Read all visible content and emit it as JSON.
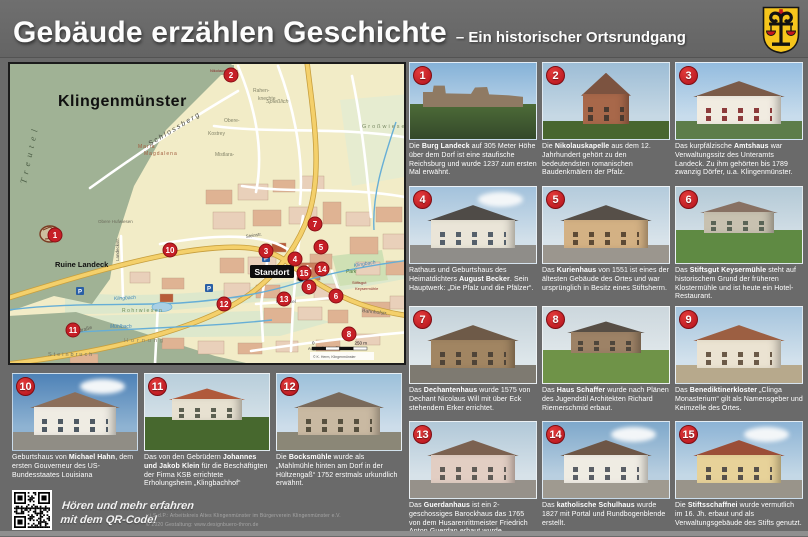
{
  "header": {
    "title": "Gebäude erzählen Geschichte",
    "subtitle": "– Ein historischer Ortsrundgang"
  },
  "map": {
    "title": "Klingenmünster",
    "standort_label": "Standort",
    "scale_zero": "0",
    "scale_label": "250 m",
    "credit": "© K. Herm, Klingenmünster",
    "labels": [
      {
        "t": "Klingenmünster",
        "x": 48,
        "y": 42,
        "s": 16,
        "c": "#101010",
        "b": true,
        "ls": 0.5
      },
      {
        "t": "Treutel",
        "x": 16,
        "y": 120,
        "s": 9,
        "c": "#4e6048",
        "r": -78,
        "i": true,
        "ls": 5,
        "serif": true
      },
      {
        "t": "S c h l o s s b e r g",
        "x": 140,
        "y": 82,
        "s": 7,
        "c": "#4a4a42",
        "r": -31,
        "i": true
      },
      {
        "t": "Ruine Landeck",
        "x": 45,
        "y": 203,
        "s": 7.5,
        "c": "#101010",
        "b": true
      },
      {
        "t": "Maria",
        "x": 128,
        "y": 84,
        "s": 5,
        "c": "#a05a3c",
        "ls": 1
      },
      {
        "t": "Magdalena",
        "x": 134,
        "y": 91,
        "s": 5,
        "c": "#a05a3c",
        "ls": 1
      },
      {
        "t": "Spießlich",
        "x": 256,
        "y": 39,
        "s": 5.5,
        "c": "#85856a",
        "i": true
      },
      {
        "t": "Obere-",
        "x": 214,
        "y": 58,
        "s": 5,
        "c": "#85856a"
      },
      {
        "t": "Kostrey",
        "x": 198,
        "y": 71,
        "s": 5,
        "c": "#85856a"
      },
      {
        "t": "Rahen-",
        "x": 243,
        "y": 28,
        "s": 5,
        "c": "#85856a"
      },
      {
        "t": "knechte",
        "x": 248,
        "y": 36,
        "s": 5,
        "c": "#85856a"
      },
      {
        "t": "Mistlara-",
        "x": 205,
        "y": 92,
        "s": 5,
        "c": "#85856a"
      },
      {
        "t": "Großwiesen",
        "x": 352,
        "y": 64,
        "s": 5.5,
        "c": "#7a8a64",
        "ls": 2
      },
      {
        "t": "Rohrwiesen",
        "x": 112,
        "y": 248,
        "s": 5,
        "c": "#6f8c55",
        "ls": 1.5
      },
      {
        "t": "Hornung",
        "x": 114,
        "y": 278,
        "s": 5.5,
        "c": "#85856a",
        "ls": 3
      },
      {
        "t": "Steinbruch",
        "x": 38,
        "y": 292,
        "s": 5.5,
        "c": "#73735f",
        "ls": 2
      },
      {
        "t": "Klingbach",
        "x": 104,
        "y": 236,
        "s": 5,
        "c": "#3e86b8",
        "i": true,
        "r": -3
      },
      {
        "t": "Klingbach",
        "x": 344,
        "y": 203,
        "s": 5,
        "c": "#3e86b8",
        "i": true,
        "r": -9
      },
      {
        "t": "Mühlbach",
        "x": 100,
        "y": 264,
        "s": 5,
        "c": "#3e86b8",
        "i": true
      },
      {
        "t": "Weinstraße",
        "x": 58,
        "y": 272,
        "s": 5,
        "c": "#5a5a52",
        "r": -17
      },
      {
        "t": "Steinstr.",
        "x": 236,
        "y": 174,
        "s": 4.5,
        "c": "#5a5a52",
        "r": -9
      },
      {
        "t": "Im Winkel",
        "x": 266,
        "y": 239,
        "s": 4.5,
        "c": "#5a5a52"
      },
      {
        "t": "Bahnhofstr.",
        "x": 352,
        "y": 248,
        "s": 5,
        "c": "#5a5a52",
        "r": 7
      },
      {
        "t": "Landeckstr.",
        "x": 109,
        "y": 197,
        "s": 4.5,
        "c": "#5a5a52",
        "r": -90
      },
      {
        "t": "Obere Hufwiesen",
        "x": 88,
        "y": 159,
        "s": 4.5,
        "c": "#6e6e5e"
      },
      {
        "t": "Nikolauskapelle",
        "x": 200,
        "y": 8,
        "s": 4,
        "c": "#8b2a2a"
      },
      {
        "t": "Park",
        "x": 336,
        "y": 209,
        "s": 5,
        "c": "#4f7a3c",
        "i": true
      },
      {
        "t": "Stiftsgut",
        "x": 342,
        "y": 220,
        "s": 4,
        "c": "#8b2a2a"
      },
      {
        "t": "Keysermühle",
        "x": 345,
        "y": 226,
        "s": 4,
        "c": "#8b2a2a"
      },
      {
        "t": "August-Becker-Str.",
        "x": 298,
        "y": 286,
        "s": 4,
        "c": "#5a5a52",
        "r": -2
      }
    ],
    "markers": [
      {
        "n": "1",
        "x": 45,
        "y": 171
      },
      {
        "n": "2",
        "x": 221,
        "y": 11
      },
      {
        "n": "3",
        "x": 256,
        "y": 187
      },
      {
        "n": "4",
        "x": 285,
        "y": 195
      },
      {
        "n": "5",
        "x": 311,
        "y": 183
      },
      {
        "n": "6",
        "x": 326,
        "y": 232
      },
      {
        "n": "7",
        "x": 305,
        "y": 160
      },
      {
        "n": "8",
        "x": 339,
        "y": 270
      },
      {
        "n": "9",
        "x": 299,
        "y": 223
      },
      {
        "n": "10",
        "x": 160,
        "y": 186
      },
      {
        "n": "11",
        "x": 63,
        "y": 266
      },
      {
        "n": "12",
        "x": 214,
        "y": 240
      },
      {
        "n": "13",
        "x": 274,
        "y": 235
      },
      {
        "n": "14",
        "x": 312,
        "y": 205
      },
      {
        "n": "15",
        "x": 294,
        "y": 209
      }
    ],
    "parking_label": "P"
  },
  "cards": [
    {
      "num": "1",
      "caption": "Die <b>Burg Landeck</b> auf 305 Meter Höhe über dem Dorf ist eine staufische Reichsburg und wurde 1237 zum ersten Mal erwähnt.",
      "photo": {
        "variant": "castle",
        "sky": "#85b2d8",
        "sky2": "#c2d8ea",
        "wall": "#8f7a63",
        "roof": "#6e5c48",
        "ground": "#4d6c38",
        "win": "#6e5c48"
      }
    },
    {
      "num": "2",
      "caption": "Die <b>Nikolauskapelle</b> aus dem 12. Jahrhundert gehört zu den bedeutendsten romanischen Baudenkmälern der Pfalz.",
      "photo": {
        "variant": "chapel",
        "sky": "#9dbdd6",
        "sky2": "#c6d8e4",
        "wall": "#a8684a",
        "roof": "#7c5340",
        "ground": "#48662f",
        "win": "#4a3a30"
      }
    },
    {
      "num": "3",
      "caption": "Das kurpfälzische <b>Amtshaus</b> war Verwaltungssitz des Unteramts Landeck. Zu ihm gehörten bis 1789 zwanzig Dörfer, u.a. Klingenmünster.",
      "photo": {
        "variant": "house",
        "sky": "#93bcdf",
        "sky2": "#c8dcec",
        "wall": "#f1ece1",
        "roof": "#7b5b49",
        "ground": "#5d7d4a",
        "win": "#8d3b3b"
      }
    },
    {
      "num": "4",
      "caption": "Rathaus und Geburtshaus des Heimatdichters <b>August Becker</b>.  Sein Hauptwerk: „Die Pfalz und die Pfälzer“.",
      "photo": {
        "variant": "house",
        "cloud": true,
        "sky": "#a3c2dc",
        "sky2": "#d2e0ea",
        "wall": "#eae5d8",
        "roof": "#4f4b47",
        "ground": "#8f8d89",
        "win": "#55606b"
      }
    },
    {
      "num": "5",
      "caption": "Das <b>Kurienhaus</b> von 1551 ist eines der ältesten Gebäude des Ortes und war ursprünglich in Besitz eines Stiftsherrn.",
      "photo": {
        "variant": "house",
        "sky": "#b4cbdc",
        "sky2": "#d8e3ea",
        "wall": "#d3b184",
        "roof": "#564f48",
        "ground": "#9b968e",
        "win": "#5d4a35"
      }
    },
    {
      "num": "6",
      "caption": "Das <b>Stiftsgut Keysermühle</b> steht auf historischem Grund der früheren Klostermühle und ist heute ein Hotel-Restaurant.",
      "photo": {
        "variant": "garden",
        "sky": "#b3c9d6",
        "sky2": "#d6e1e8",
        "wall": "#c8c1b0",
        "roof": "#887163",
        "ground": "#5f8a43",
        "win": "#5a6456"
      }
    },
    {
      "num": "7",
      "caption": "Das <b>Dechantenhaus</b> wurde 1575 von Dechant Nicolaus Will mit über Eck stehendem Erker errichtet.",
      "photo": {
        "variant": "house",
        "sky": "#c3d1d9",
        "sky2": "#dde6ea",
        "wall": "#a18562",
        "roof": "#6e5a48",
        "ground": "#7e7a71",
        "win": "#4f4438"
      }
    },
    {
      "num": "8",
      "caption": "Das <b>Haus Schaffer</b> wurde nach Plänen des Jugendstil Architekten Richard Riemerschmid erbaut.",
      "photo": {
        "variant": "garden",
        "sky": "#ccd7dd",
        "sky2": "#e2e9ec",
        "wall": "#9d8266",
        "roof": "#574e45",
        "ground": "#6f9348",
        "win": "#4e463c"
      }
    },
    {
      "num": "9",
      "caption": "Das <b>Benediktinerkloster</b> „Clinga Monasterium“ gilt als Namensgeber und Keimzelle des Ortes.",
      "photo": {
        "variant": "house",
        "sky": "#a5c4dd",
        "sky2": "#d2e1ec",
        "wall": "#ebe3d2",
        "roof": "#9c5f42",
        "ground": "#b7a98c",
        "win": "#6b5a48"
      }
    },
    {
      "num": "10",
      "caption": "Geburtshaus von <b>Michael Hahn</b>, dem ersten Gouverneur des US-Bundesstaates Louisiana",
      "photo": {
        "variant": "house",
        "cloud": true,
        "sky": "#4e82b7",
        "sky2": "#8fb3d2",
        "wall": "#efece3",
        "roof": "#8b6e5a",
        "ground": "#908d85",
        "win": "#4f5a64"
      }
    },
    {
      "num": "11",
      "caption": "Das von den Gebrüdern <b>Johannes und Jakob Klein</b> für die Beschäftigten der Firma KSB errichtete Erholungsheim „Klingbachhof“",
      "photo": {
        "variant": "garden",
        "sky": "#b8cedb",
        "sky2": "#d9e4ea",
        "wall": "#e7e1d1",
        "roof": "#b05a3b",
        "ground": "#47682e",
        "win": "#5c6052"
      }
    },
    {
      "num": "12",
      "caption": "Die <b>Bocksmühle</b> wurde als „Mahlmühle hinten am Dorf in der Hültzengaß“ 1752 erstmals urkundlich erwähnt.",
      "photo": {
        "variant": "house",
        "sky": "#9cc0da",
        "sky2": "#cdddea",
        "wall": "#c9b9a2",
        "roof": "#79695a",
        "ground": "#8b8777",
        "win": "#57503f"
      }
    },
    {
      "num": "13",
      "caption": "Das <b>Guerdanhaus</b> ist ein 2-geschossiges Barockhaus das 1765 von dem Husarenrittmeister Friedrich Anton Guerdan erbaut wurde.",
      "photo": {
        "variant": "house",
        "sky": "#b1c8d8",
        "sky2": "#d7e2e9",
        "wall": "#e2cec3",
        "roof": "#7b6150",
        "ground": "#96918a",
        "win": "#5f5b56"
      }
    },
    {
      "num": "14",
      "caption": "Das <b>katholische Schulhaus</b> wurde 1827 mit Portal und Rundbogenblende erstellt.",
      "photo": {
        "variant": "house",
        "cloud": true,
        "sky": "#7ea8cb",
        "sky2": "#b9cfe0",
        "wall": "#efece3",
        "roof": "#6d5646",
        "ground": "#9f9a90",
        "win": "#5a5f66"
      }
    },
    {
      "num": "15",
      "caption": "Die <b>Stiftsschaffnei</b> wurde vermutlich im 16. Jh. erbaut und als Verwaltungsgebäude des Stifts genutzt.",
      "photo": {
        "variant": "house",
        "cloud": true,
        "sky": "#8cb3d5",
        "sky2": "#c4d8e6",
        "wall": "#e7d299",
        "roof": "#9b4e37",
        "ground": "#99948a",
        "win": "#56514b"
      }
    }
  ],
  "card_layout": {
    "right": [
      0,
      1,
      2,
      3,
      4,
      5,
      6,
      7,
      8,
      12,
      13,
      14
    ],
    "bottom": [
      9,
      10,
      11
    ]
  },
  "audio": {
    "line1": "Hören und mehr erfahren",
    "line2": "mit dem QR-Code!"
  },
  "footer": {
    "line1": "v.i.S.d.P.: Arbeitskreis Altes Klingenmünster im Bürgerverein Klingenmünster e.V.",
    "line2": "© 2020 Gestaltung: www.designbuero-thron.de"
  },
  "colors": {
    "badge": "#c0161d",
    "marker": "#c61f26",
    "background": "#6a6a6a",
    "map_forest": "#a0b295",
    "map_field": "#f2ecc7",
    "main_road": "#f4d06b"
  }
}
